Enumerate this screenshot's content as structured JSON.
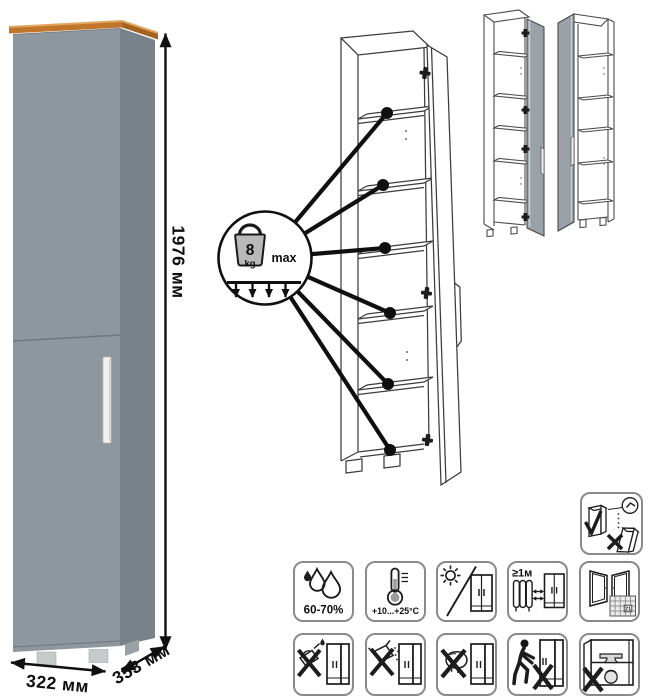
{
  "product": {
    "render": {
      "dimensions": {
        "height_label": "1976 мм",
        "width_label": "322 мм",
        "depth_label": "353 мм"
      },
      "colors": {
        "front": "#8e979d",
        "side": "#78828a",
        "top_trim": "#c0752b",
        "handle": "#f1f1ef"
      }
    },
    "shelf_diagram": {
      "shelf_count": 6,
      "callout": {
        "weight_value": "8",
        "weight_unit": "kg",
        "max_label": "max"
      }
    },
    "door_variants": {
      "left": "door-hinged-right-variant",
      "right": "door-hinged-left-variant"
    }
  },
  "care_pictograms": {
    "wall_mount": {
      "name": "anchor-to-wall-icon"
    },
    "row1": [
      {
        "name": "humidity-icon",
        "label": "60-70%"
      },
      {
        "name": "temperature-icon",
        "label": "+10...+25°C"
      },
      {
        "name": "no-direct-sunlight-icon",
        "label": ""
      },
      {
        "name": "heat-source-distance-icon",
        "label": "≥1м"
      },
      {
        "name": "ventilation-acclimatization-icon",
        "calendar_day": "21"
      }
    ],
    "row2": [
      {
        "name": "no-solvents-icon"
      },
      {
        "name": "no-abrasives-icon"
      },
      {
        "name": "no-wet-cleaning-icon"
      },
      {
        "name": "no-dragging-icon"
      },
      {
        "name": "no-heavy-load-icon"
      }
    ]
  }
}
